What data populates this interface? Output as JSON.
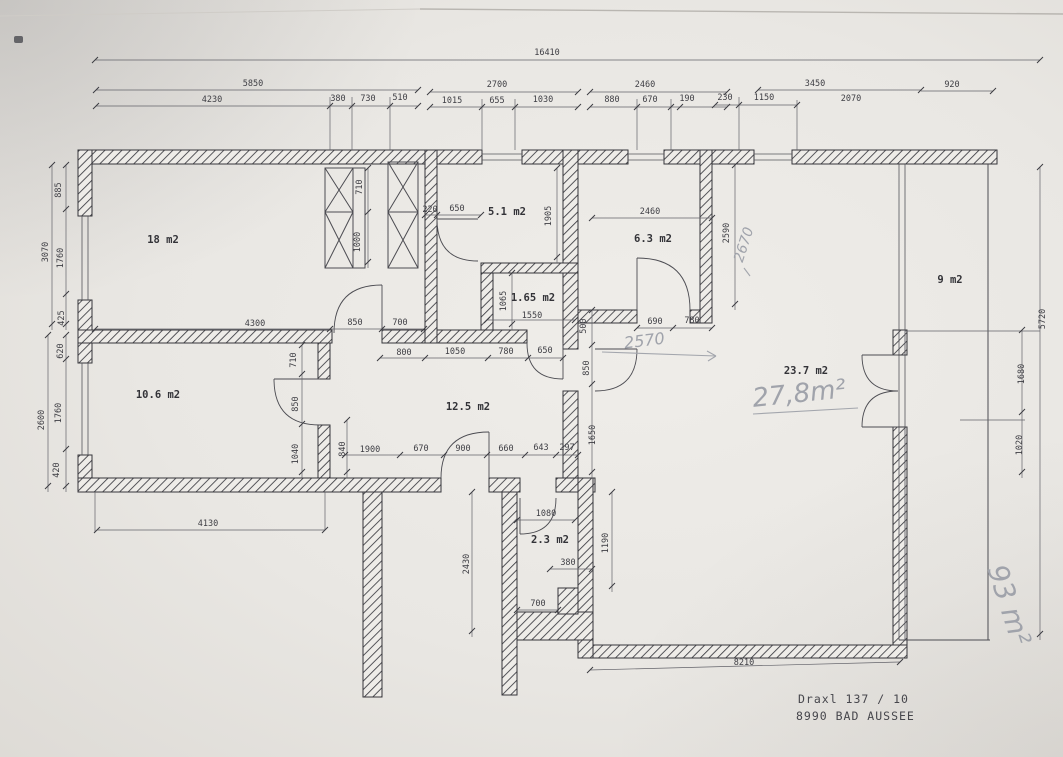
{
  "address": {
    "line1": "Draxl 137 / 10",
    "line2": "8990 BAD AUSSEE"
  },
  "rooms": [
    {
      "text": "18 m2",
      "x": 163,
      "y": 243
    },
    {
      "text": "5.1 m2",
      "x": 507,
      "y": 215
    },
    {
      "text": "1.65 m2",
      "x": 533,
      "y": 301
    },
    {
      "text": "6.3 m2",
      "x": 653,
      "y": 242
    },
    {
      "text": "9 m2",
      "x": 950,
      "y": 283
    },
    {
      "text": "23.7 m2",
      "x": 806,
      "y": 374
    },
    {
      "text": "10.6 m2",
      "x": 158,
      "y": 398
    },
    {
      "text": "12.5 m2",
      "x": 468,
      "y": 410
    },
    {
      "text": "2.3 m2",
      "x": 550,
      "y": 543
    }
  ],
  "dimensions": [
    {
      "text": "16410",
      "x": 547,
      "y": 55
    },
    {
      "text": "5850",
      "x": 253,
      "y": 86
    },
    {
      "text": "2700",
      "x": 497,
      "y": 87
    },
    {
      "text": "2460",
      "x": 645,
      "y": 87
    },
    {
      "text": "3450",
      "x": 815,
      "y": 86
    },
    {
      "text": "920",
      "x": 952,
      "y": 87
    },
    {
      "text": "4230",
      "x": 212,
      "y": 102
    },
    {
      "text": "380",
      "x": 338,
      "y": 101
    },
    {
      "text": "730",
      "x": 368,
      "y": 101
    },
    {
      "text": "510",
      "x": 400,
      "y": 100
    },
    {
      "text": "1015",
      "x": 452,
      "y": 103
    },
    {
      "text": "655",
      "x": 497,
      "y": 103
    },
    {
      "text": "1030",
      "x": 543,
      "y": 102
    },
    {
      "text": "880",
      "x": 612,
      "y": 102
    },
    {
      "text": "670",
      "x": 650,
      "y": 102
    },
    {
      "text": "190",
      "x": 687,
      "y": 101
    },
    {
      "text": "230",
      "x": 725,
      "y": 100
    },
    {
      "text": "1150",
      "x": 764,
      "y": 100
    },
    {
      "text": "2070",
      "x": 851,
      "y": 101
    },
    {
      "text": "3070",
      "x": 48,
      "y": 252,
      "rot": -90
    },
    {
      "text": "885",
      "x": 61,
      "y": 190,
      "rot": -90
    },
    {
      "text": "1760",
      "x": 63,
      "y": 258,
      "rot": -90
    },
    {
      "text": "425",
      "x": 64,
      "y": 318,
      "rot": -90
    },
    {
      "text": "2600",
      "x": 44,
      "y": 420,
      "rot": -90
    },
    {
      "text": "620",
      "x": 63,
      "y": 351,
      "rot": -90
    },
    {
      "text": "1760",
      "x": 61,
      "y": 413,
      "rot": -90
    },
    {
      "text": "420",
      "x": 59,
      "y": 470,
      "rot": -90
    },
    {
      "text": "4300",
      "x": 255,
      "y": 326
    },
    {
      "text": "850",
      "x": 355,
      "y": 325
    },
    {
      "text": "700",
      "x": 400,
      "y": 325
    },
    {
      "text": "710",
      "x": 362,
      "y": 187,
      "rot": -90
    },
    {
      "text": "1000",
      "x": 360,
      "y": 242,
      "rot": -90
    },
    {
      "text": "220",
      "x": 430,
      "y": 212
    },
    {
      "text": "650",
      "x": 457,
      "y": 211
    },
    {
      "text": "1905",
      "x": 551,
      "y": 216,
      "rot": -90
    },
    {
      "text": "1065",
      "x": 506,
      "y": 301,
      "rot": -90
    },
    {
      "text": "1550",
      "x": 532,
      "y": 318
    },
    {
      "text": "2460",
      "x": 650,
      "y": 214
    },
    {
      "text": "2590",
      "x": 729,
      "y": 233,
      "rot": -90
    },
    {
      "text": "690",
      "x": 655,
      "y": 324
    },
    {
      "text": "780",
      "x": 692,
      "y": 323
    },
    {
      "text": "500",
      "x": 586,
      "y": 326,
      "rot": -90
    },
    {
      "text": "800",
      "x": 404,
      "y": 355
    },
    {
      "text": "1050",
      "x": 455,
      "y": 354
    },
    {
      "text": "780",
      "x": 506,
      "y": 354
    },
    {
      "text": "650",
      "x": 545,
      "y": 353
    },
    {
      "text": "1900",
      "x": 370,
      "y": 452
    },
    {
      "text": "670",
      "x": 421,
      "y": 451
    },
    {
      "text": "900",
      "x": 463,
      "y": 451
    },
    {
      "text": "660",
      "x": 506,
      "y": 451
    },
    {
      "text": "643",
      "x": 541,
      "y": 450
    },
    {
      "text": "297",
      "x": 567,
      "y": 450
    },
    {
      "text": "840",
      "x": 345,
      "y": 449,
      "rot": -90
    },
    {
      "text": "710",
      "x": 296,
      "y": 360,
      "rot": -90
    },
    {
      "text": "850",
      "x": 298,
      "y": 404,
      "rot": -90
    },
    {
      "text": "1040",
      "x": 298,
      "y": 454,
      "rot": -90
    },
    {
      "text": "850",
      "x": 589,
      "y": 368,
      "rot": -90
    },
    {
      "text": "1650",
      "x": 595,
      "y": 435,
      "rot": -90
    },
    {
      "text": "5720",
      "x": 1045,
      "y": 319,
      "rot": -90
    },
    {
      "text": "1680",
      "x": 1024,
      "y": 374,
      "rot": -90
    },
    {
      "text": "1020",
      "x": 1022,
      "y": 445,
      "rot": -90
    },
    {
      "text": "1080",
      "x": 546,
      "y": 516
    },
    {
      "text": "380",
      "x": 568,
      "y": 565
    },
    {
      "text": "700",
      "x": 538,
      "y": 606
    },
    {
      "text": "2430",
      "x": 469,
      "y": 564,
      "rot": -90
    },
    {
      "text": "1190",
      "x": 608,
      "y": 543,
      "rot": -90
    },
    {
      "text": "4130",
      "x": 208,
      "y": 526
    },
    {
      "text": "8210",
      "x": 744,
      "y": 665
    }
  ],
  "handwritten": [
    {
      "text": "2670",
      "x": 748,
      "y": 246,
      "rot": -72,
      "size": 14
    },
    {
      "text": "2570",
      "x": 645,
      "y": 346,
      "rot": -7,
      "size": 16
    },
    {
      "text": "27,8m²",
      "x": 800,
      "y": 402,
      "rot": -6,
      "size": 26
    },
    {
      "text": "93 m²",
      "x": 1000,
      "y": 608,
      "rot": 72,
      "size": 28
    }
  ],
  "colors": {
    "paper": "#eceae6",
    "ink": "#3c3c42",
    "pencil": "#a0a3ab"
  }
}
